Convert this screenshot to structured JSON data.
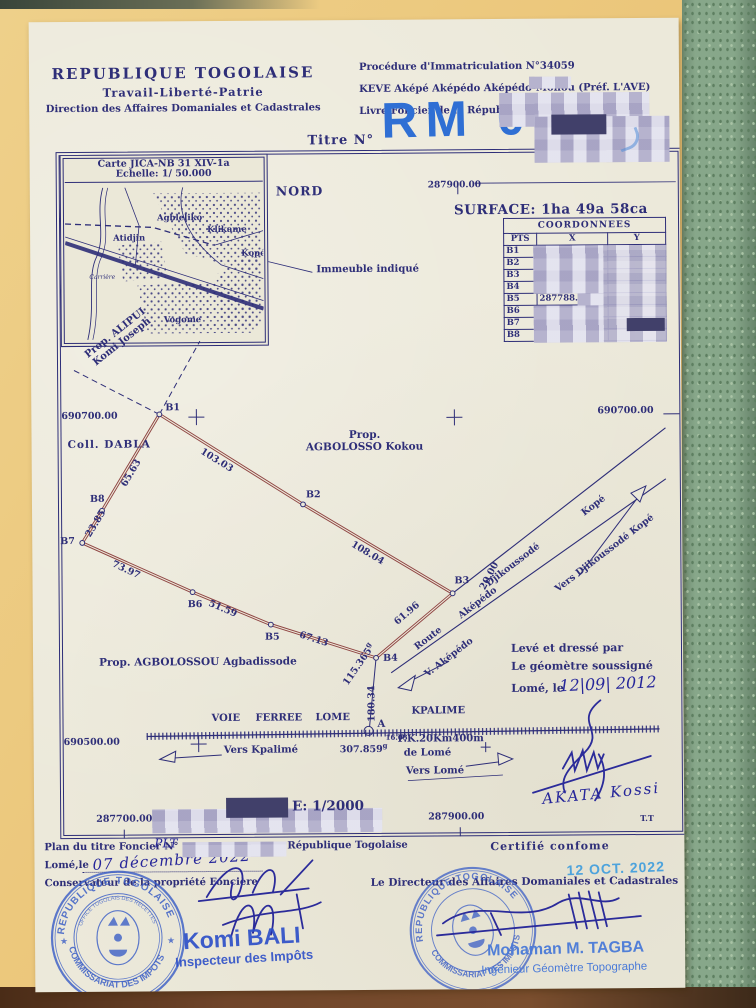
{
  "header": {
    "republic": "REPUBLIQUE TOGOLAISE",
    "motto": "Travail-Liberté-Patrie",
    "direction": "Direction des Affaires Domaniales et Cadastrales",
    "titre_label": "Titre N°",
    "rm_number": "RM 021",
    "procedure": "Procédure d'Immatriculation N°34059",
    "lieu": "KEVE Aképé Aképédo Aképédo-Monou (Préf. L'AVE)",
    "livre": "Livre Foncier de la Répub"
  },
  "map_inset": {
    "title": "Carte JICA-NB 31 XIV-1a",
    "scale": "Echelle: 1/ 50.000",
    "places": {
      "agbleliko": "Agbleliko",
      "klikame": "Klikame",
      "atidjin": "Atidjin",
      "kope": "Kopé",
      "vogome": "Vogome",
      "carriere": "Carrière"
    }
  },
  "plan": {
    "nord": "NORD",
    "surface": "SURFACE: 1ha 49a 58ca",
    "immeuble": "Immeuble indiqué",
    "grid": {
      "top_x": "287900.00",
      "y_left": "690700.00",
      "y_right": "690700.00",
      "y_left_bottom": "690500.00",
      "x_bottom_left": "287700.00",
      "x_bottom_right": "287900.00",
      "scale": "E: 1/2000"
    },
    "vertices": [
      "B1",
      "B2",
      "B3",
      "B4",
      "B5",
      "B6",
      "B7",
      "B8"
    ],
    "edges": {
      "b1b2": "103.03",
      "b2b3": "108.04",
      "b3b4": "61.96",
      "b4b5": "67.13",
      "b5b6": "51.59",
      "b6b7": "73.97",
      "b7b8": "23.85",
      "b8b1": "65.63"
    },
    "angle_b4": "115.365",
    "grad_suffix": "g",
    "b4_to_rail": "180.34",
    "road_width": "20.00",
    "neighbors": {
      "alipui1": "Prop. ALIPUI",
      "alipui2": "Komi Joseph",
      "dabla": "Coll. DABLA",
      "agbolosso1": "Prop.",
      "agbolosso2": "AGBOLOSSO Kokou",
      "agbolossou": "Prop. AGBOLOSSOU Agbadissode"
    },
    "road": {
      "w1": "Route",
      "w2": "Aképédo",
      "w3": "Djikoussodé",
      "w4": "Kopé",
      "vers": "Vers Djikoussodé Kopé",
      "v_akepedo": "V. Aképédo"
    },
    "railway": {
      "w1": "VOIE",
      "w2": "FERREE",
      "w3": "LOME",
      "w4": "KPALIME",
      "point": "A",
      "dist": "16.03",
      "bearing": "307.859",
      "pk1": "P.K.20Km400m",
      "pk2": "de Lomé",
      "vers_kpalime": "Vers Kpalimé",
      "vers_lome": "Vers Lomé"
    },
    "surveyor": {
      "l1": "Levé et dressé par",
      "l2": "Le géomètre soussigné",
      "l3": "Lomé, le",
      "date": "12|09| 2012",
      "name": "AKATA Kossi",
      "tt": "T.T"
    }
  },
  "coord_table": {
    "title": "COORDONNEES",
    "cols": [
      "PTS",
      "X",
      "Y"
    ],
    "rows": [
      {
        "pt": "B1",
        "x": "",
        "y": ""
      },
      {
        "pt": "B2",
        "x": "",
        "y": ""
      },
      {
        "pt": "B3",
        "x": "",
        "y": ""
      },
      {
        "pt": "B4",
        "x": "",
        "y": ""
      },
      {
        "pt": "B5",
        "x": "287788.92",
        "y": ""
      },
      {
        "pt": "B6",
        "x": "",
        "y": ""
      },
      {
        "pt": "B7",
        "x": "",
        "y": ""
      },
      {
        "pt": "B8",
        "x": "",
        "y": ""
      }
    ]
  },
  "footer": {
    "plan_line": "Plan du titre Foncier N°",
    "plan_no_hw": "PLT",
    "republique": "République Togolaise",
    "certifie": "Certifié confome",
    "lome_le": "Lomé,le",
    "date_hw": "07 décembre 2022",
    "conservateur": "Conservateur de la propriété Foncière",
    "date_stamp": "12 OCT. 2022",
    "directeur": "Le Directeur des Affaires Domaniales et Cadastrales"
  },
  "stamps": {
    "round_top": "REPUBLIQUE TOGOLAISE",
    "round_bottom": "COMMISSARIAT DES IMPOTS",
    "round_inner": "OFFICE TOGOLAIS DES RECETTES",
    "bali_name": "Komi BALI",
    "bali_title": "Inspecteur des Impôts",
    "tagba_name": "Mohaman M. TAGBA",
    "tagba_title": "Ingénieur Géomètre Topographe"
  },
  "colors": {
    "ink": "#2e2e78",
    "plot": "#8f4442",
    "stamp_blue": "#3b5ec6",
    "rm_blue": "#2f6fd4",
    "date_blue": "#4da3dc",
    "paper": "#ece9da"
  }
}
